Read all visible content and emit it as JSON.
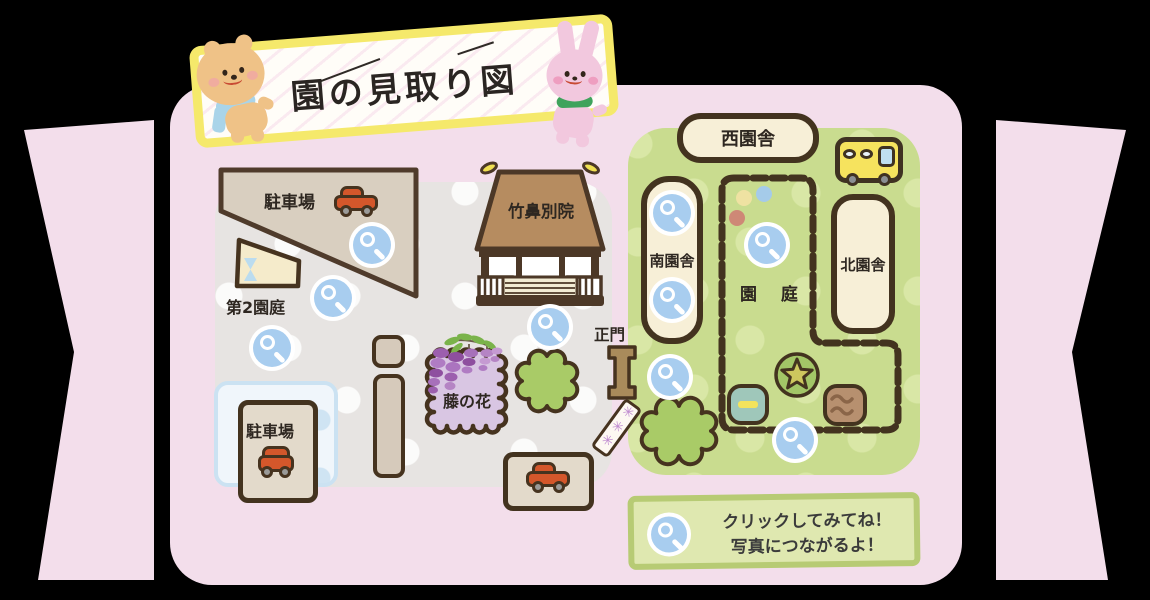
{
  "banner": {
    "title": "園の見取り図"
  },
  "left_map": {
    "parking_top": {
      "label": "駐車場"
    },
    "second_garden": {
      "label": "第2園庭"
    },
    "temple": {
      "label": "竹鼻別院"
    },
    "wisteria": {
      "label": "藤の花"
    },
    "gate": {
      "label": "正門"
    },
    "parking_bottom": {
      "label": "駐車場"
    }
  },
  "right_map": {
    "west_building": {
      "label": "西園舎"
    },
    "south_building": {
      "label": "南園舎"
    },
    "north_building": {
      "label": "北園舎"
    },
    "garden": {
      "label": "園 庭"
    }
  },
  "legend": {
    "line1": "クリックしてみてね！",
    "line2": "写真につながるよ！"
  },
  "icons": {
    "flower_sign": "✳✳✳",
    "magnifier": "magnifier-hotspot",
    "bus": "school-bus",
    "car": "car"
  },
  "colors": {
    "background": "#000000",
    "panel_pink": "#F3DEEB",
    "map_gray": "#E7E4E2",
    "map_green": "#C9DC8F",
    "outline_brown": "#46331F",
    "building_cream": "#F7EFD7",
    "building_tan": "#E0D6C6",
    "hotspot_blue": "#A8CDEF",
    "car_orange": "#D4572B",
    "bus_yellow": "#F6E35E",
    "banner_yellow": "#F5E96B",
    "wisteria_purple": "#D9C6E3",
    "legend_green": "#DFE8B0"
  }
}
